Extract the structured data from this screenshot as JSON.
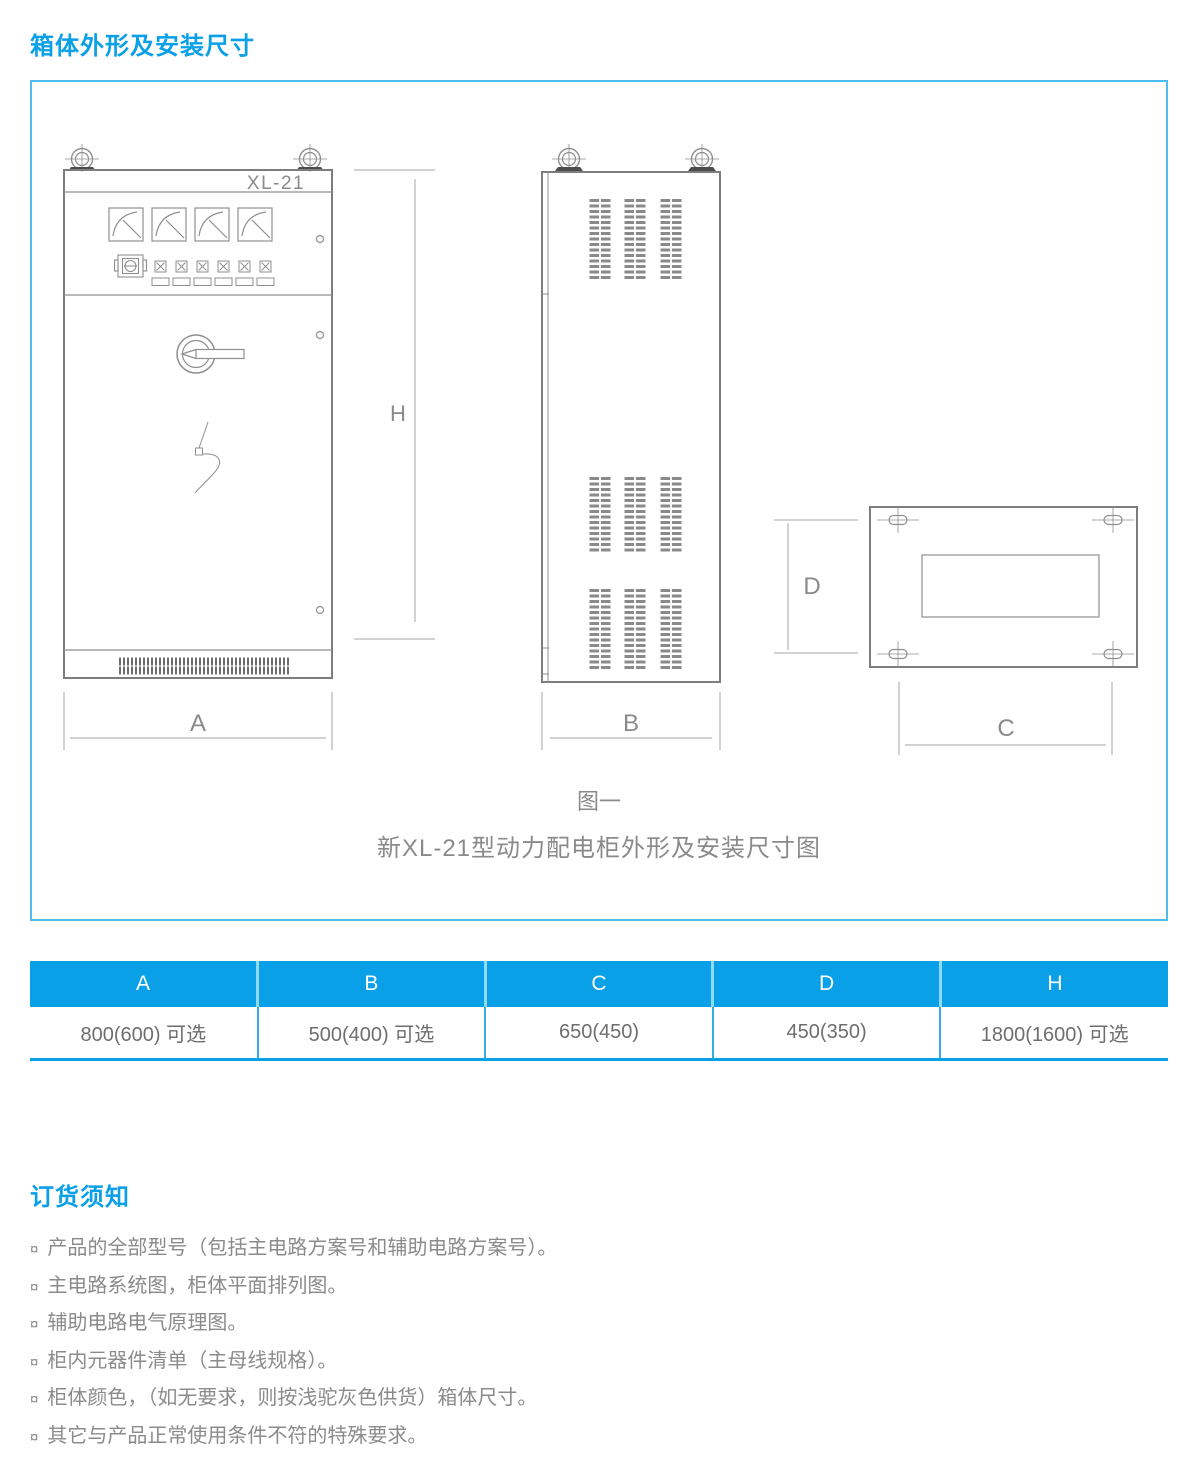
{
  "header": {
    "section1_title": "箱体外形及安装尺寸",
    "section2_title": "订货须知"
  },
  "diagram": {
    "labels": {
      "model": "XL-21",
      "dim_a": "A",
      "dim_b": "B",
      "dim_c": "C",
      "dim_d": "D",
      "dim_h": "H"
    },
    "caption_line1": "图一",
    "caption_line2": "新XL-21型动力配电柜外形及安装尺寸图"
  },
  "dimension_table": {
    "columns": [
      "A",
      "B",
      "C",
      "D",
      "H"
    ],
    "values": [
      "800(600) 可选",
      "500(400) 可选",
      "650(450)",
      "450(350)",
      "1800(1600) 可选"
    ]
  },
  "ordering": {
    "bullet": "¤",
    "items": [
      "产品的全部型号（包括主电路方案号和辅助电路方案号）。",
      "主电路系统图，柜体平面排列图。",
      "辅助电路电气原理图。",
      "柜内元器件清单（主母线规格）。",
      "柜体颜色，（如无要求，则按浅驼灰色供货）箱体尺寸。",
      "其它与产品正常使用条件不符的特殊要求。"
    ]
  },
  "colors": {
    "accent": "#0aa0e8",
    "box_border": "#4fbcee",
    "drawing_line": "#8f8f8f",
    "text_gray": "#8a8a8a"
  }
}
